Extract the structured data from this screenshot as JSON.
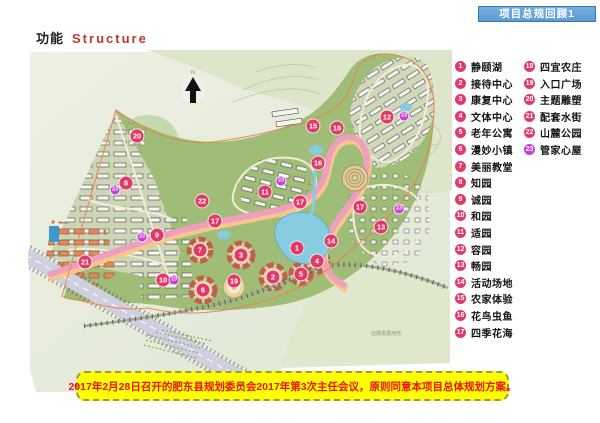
{
  "header": {
    "badge_label": "项目总规回顾1",
    "badge_color": "#5b9bd5"
  },
  "title": {
    "zh": "功能",
    "en": "Structure"
  },
  "legend": {
    "primary_color": "#e23a68",
    "secondary_color": "#cb3ed6",
    "column1": [
      {
        "num": "1",
        "label": "静颐湖",
        "type": "primary"
      },
      {
        "num": "2",
        "label": "接待中心",
        "type": "primary"
      },
      {
        "num": "3",
        "label": "康复中心",
        "type": "primary"
      },
      {
        "num": "4",
        "label": "文体中心",
        "type": "primary"
      },
      {
        "num": "5",
        "label": "老年公寓",
        "type": "primary"
      },
      {
        "num": "6",
        "label": "漫妙小镇",
        "type": "primary"
      },
      {
        "num": "7",
        "label": "美丽教堂",
        "type": "primary"
      },
      {
        "num": "8",
        "label": "知园",
        "type": "primary"
      },
      {
        "num": "9",
        "label": "诚园",
        "type": "primary"
      },
      {
        "num": "10",
        "label": "和园",
        "type": "primary"
      },
      {
        "num": "11",
        "label": "适园",
        "type": "primary"
      },
      {
        "num": "12",
        "label": "容园",
        "type": "primary"
      },
      {
        "num": "13",
        "label": "畅园",
        "type": "primary"
      },
      {
        "num": "14",
        "label": "活动场地",
        "type": "primary"
      },
      {
        "num": "15",
        "label": "农家体验",
        "type": "primary"
      },
      {
        "num": "16",
        "label": "花鸟虫鱼",
        "type": "primary"
      },
      {
        "num": "17",
        "label": "四季花海",
        "type": "primary"
      }
    ],
    "column2": [
      {
        "num": "18",
        "label": "四宜农庄",
        "type": "primary"
      },
      {
        "num": "19",
        "label": "入口广场",
        "type": "primary"
      },
      {
        "num": "20",
        "label": "主题雕塑",
        "type": "primary"
      },
      {
        "num": "21",
        "label": "配套水街",
        "type": "primary"
      },
      {
        "num": "22",
        "label": "山麓公园",
        "type": "primary"
      },
      {
        "num": "23",
        "label": "管家心屋",
        "type": "secondary"
      }
    ]
  },
  "map": {
    "north_label": "N",
    "future_land_label": "远期发展用地",
    "markers": [
      {
        "num": "1",
        "x": 269,
        "y": 198,
        "type": "primary"
      },
      {
        "num": "2",
        "x": 245,
        "y": 227,
        "type": "primary"
      },
      {
        "num": "3",
        "x": 213,
        "y": 205,
        "type": "primary"
      },
      {
        "num": "4",
        "x": 289,
        "y": 211,
        "type": "primary"
      },
      {
        "num": "5",
        "x": 273,
        "y": 224,
        "type": "primary"
      },
      {
        "num": "6",
        "x": 175,
        "y": 240,
        "type": "primary"
      },
      {
        "num": "7",
        "x": 172,
        "y": 200,
        "type": "primary"
      },
      {
        "num": "8",
        "x": 98,
        "y": 133,
        "type": "primary"
      },
      {
        "num": "9",
        "x": 129,
        "y": 185,
        "type": "primary"
      },
      {
        "num": "10",
        "x": 135,
        "y": 230,
        "type": "primary"
      },
      {
        "num": "11",
        "x": 237,
        "y": 142,
        "type": "primary"
      },
      {
        "num": "12",
        "x": 359,
        "y": 67,
        "type": "primary"
      },
      {
        "num": "13",
        "x": 353,
        "y": 177,
        "type": "primary"
      },
      {
        "num": "14",
        "x": 303,
        "y": 191,
        "type": "primary"
      },
      {
        "num": "15",
        "x": 285,
        "y": 76,
        "type": "primary"
      },
      {
        "num": "16",
        "x": 290,
        "y": 113,
        "type": "primary"
      },
      {
        "num": "17",
        "x": 187,
        "y": 171,
        "type": "primary"
      },
      {
        "num": "17",
        "x": 272,
        "y": 152,
        "type": "primary"
      },
      {
        "num": "17",
        "x": 332,
        "y": 157,
        "type": "primary"
      },
      {
        "num": "18",
        "x": 309,
        "y": 78,
        "type": "primary"
      },
      {
        "num": "19",
        "x": 206,
        "y": 231,
        "type": "primary"
      },
      {
        "num": "20",
        "x": 109,
        "y": 86,
        "type": "primary"
      },
      {
        "num": "21",
        "x": 57,
        "y": 212,
        "type": "primary"
      },
      {
        "num": "22",
        "x": 174,
        "y": 151,
        "type": "primary"
      },
      {
        "num": "23",
        "x": 87,
        "y": 140,
        "type": "secondary"
      },
      {
        "num": "23",
        "x": 114,
        "y": 187,
        "type": "secondary"
      },
      {
        "num": "23",
        "x": 146,
        "y": 230,
        "type": "secondary"
      },
      {
        "num": "23",
        "x": 253,
        "y": 131,
        "type": "secondary"
      },
      {
        "num": "23",
        "x": 376,
        "y": 66,
        "type": "secondary"
      },
      {
        "num": "23",
        "x": 371,
        "y": 159,
        "type": "secondary"
      }
    ]
  },
  "footer": {
    "note": "2017年2月28日召开的肥东县规划委员会2017年第3次主任会议，原则同意本项目总体规划方案。"
  }
}
